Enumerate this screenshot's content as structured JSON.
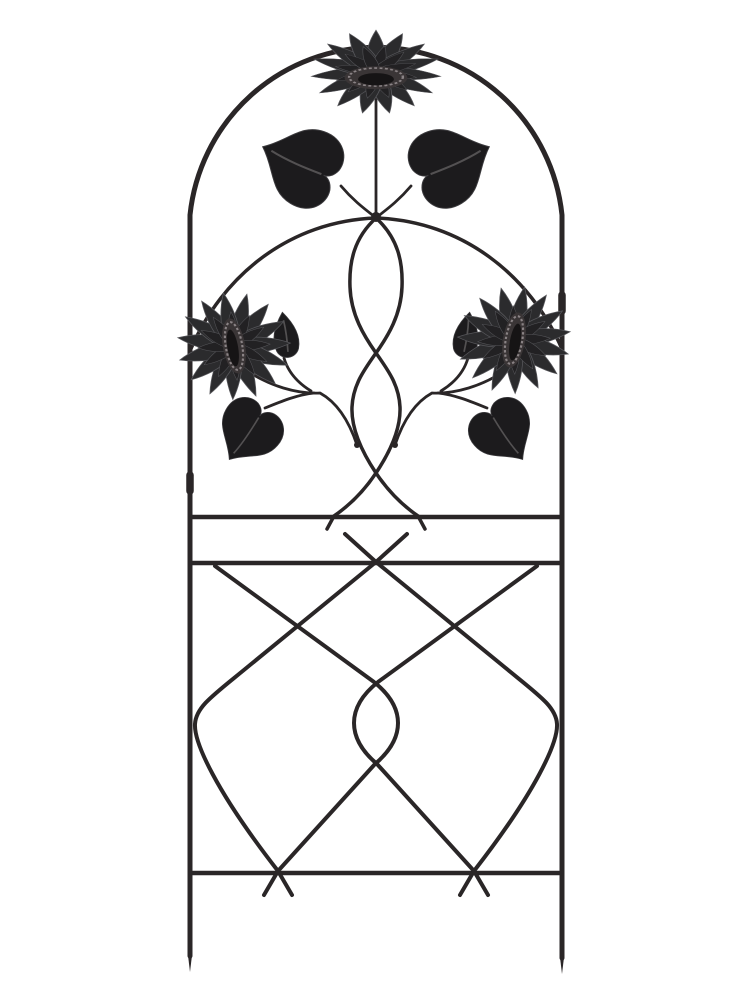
{
  "scene": {
    "type": "product-photo",
    "subject": "black metal sunflower garden trellis",
    "orientation": "upright arched panel on white background"
  },
  "colors": {
    "background": "#ffffff",
    "wire": "#2a2627",
    "petal_fill": "#2b2b2d",
    "petal_inner_fill": "#222123",
    "leaf_fill": "#1c1b1d",
    "leaf_vein": "#5d5a5c",
    "disc_fill": "#3a3536",
    "disc_ring": "#8a8385",
    "disc_core": "#161415"
  },
  "structure": {
    "flower_count": 3,
    "top_heart_leaf_count": 2,
    "side_heart_leaf_count": 2,
    "bud_leaf_count": 2,
    "horizontal_bar_count": 3,
    "ground_leg_count": 2,
    "top_section": "arched frame, center sunflower on straight stem, two drooping heart leaves, inner arch and double-twist scroll flanked by two tilted sunflowers",
    "bottom_section": "square lattice panel of crossed diagonals with rounded corners and a central twist, ending in pointed ground stakes"
  }
}
